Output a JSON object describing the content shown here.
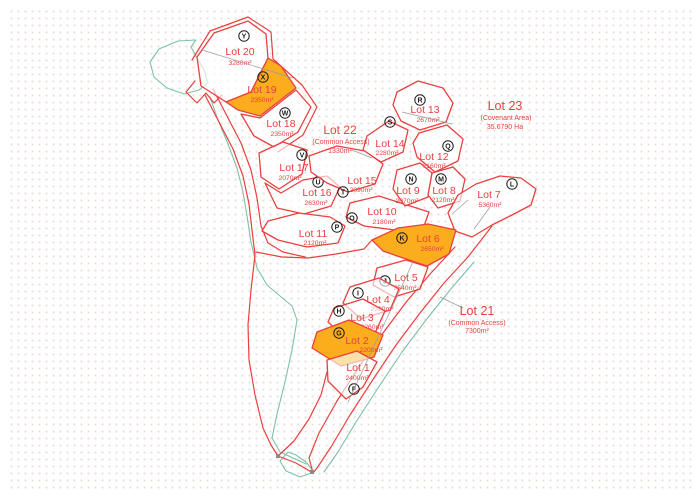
{
  "map": {
    "colors": {
      "boundary": "#e8403f",
      "label_text": "#e8403f",
      "highlight_fill": "#fbad1d",
      "coastline": "#7cc2a7",
      "marker_ink": "#1a1a1a",
      "survey_line": "#999999",
      "background_dots": "#ecdfda"
    },
    "lots": [
      {
        "id": "lot20",
        "name": "Lot 20",
        "area": "3280m²",
        "marker": "Y",
        "highlighted": false
      },
      {
        "id": "lot19",
        "name": "Lot 19",
        "area": "2350m²",
        "marker": "X",
        "highlighted": true
      },
      {
        "id": "lot18",
        "name": "Lot 18",
        "area": "2350m²",
        "marker": "W",
        "highlighted": false
      },
      {
        "id": "lot17",
        "name": "Lot 17",
        "area": "2070m²",
        "marker": "V",
        "highlighted": false
      },
      {
        "id": "lot16",
        "name": "Lot 16",
        "area": "2630m²",
        "marker": "U",
        "highlighted": false
      },
      {
        "id": "lot15",
        "name": "Lot 15",
        "area": "2090m²",
        "marker": "T",
        "highlighted": false
      },
      {
        "id": "lot14",
        "name": "Lot 14",
        "area": "2280m²",
        "marker": "S",
        "highlighted": false
      },
      {
        "id": "lot13",
        "name": "Lot 13",
        "area": "2670m²",
        "marker": "R",
        "highlighted": false
      },
      {
        "id": "lot12",
        "name": "Lot 12",
        "area": "2160m²",
        "marker": "Q",
        "highlighted": false
      },
      {
        "id": "lot11",
        "name": "Lot 11",
        "area": "2120m²",
        "marker": "P",
        "highlighted": false
      },
      {
        "id": "lot10",
        "name": "Lot 10",
        "area": "2180m²",
        "marker": "O",
        "highlighted": false
      },
      {
        "id": "lot9",
        "name": "Lot 9",
        "area": "2070m²",
        "marker": "N",
        "highlighted": false
      },
      {
        "id": "lot8",
        "name": "Lot 8",
        "area": "2120m²",
        "marker": "M",
        "highlighted": false
      },
      {
        "id": "lot7",
        "name": "Lot 7",
        "area": "5360m²",
        "marker": "L",
        "highlighted": false
      },
      {
        "id": "lot6",
        "name": "Lot 6",
        "area": "2650m²",
        "marker": "K",
        "highlighted": true
      },
      {
        "id": "lot5",
        "name": "Lot 5",
        "area": "2540m²",
        "marker": "J",
        "highlighted": false
      },
      {
        "id": "lot4",
        "name": "Lot 4",
        "area": "2380m²",
        "marker": "I",
        "highlighted": false
      },
      {
        "id": "lot3",
        "name": "Lot 3",
        "area": "2260m²",
        "marker": "H",
        "highlighted": false
      },
      {
        "id": "lot2",
        "name": "Lot 2",
        "area": "2200m²",
        "marker": "G",
        "highlighted": true
      },
      {
        "id": "lot1",
        "name": "Lot 1",
        "area": "2400m²",
        "marker": "F",
        "highlighted": false
      }
    ],
    "annotations": [
      {
        "id": "lot22",
        "name": "Lot 22",
        "sub": "(Common Access)",
        "area": "1330m²"
      },
      {
        "id": "lot23",
        "name": "Lot 23",
        "sub": "(Covenant Area)",
        "area": "35.6790 Ha"
      },
      {
        "id": "lot21",
        "name": "Lot 21",
        "sub": "(Common Access)",
        "area": "7300m²"
      }
    ]
  }
}
